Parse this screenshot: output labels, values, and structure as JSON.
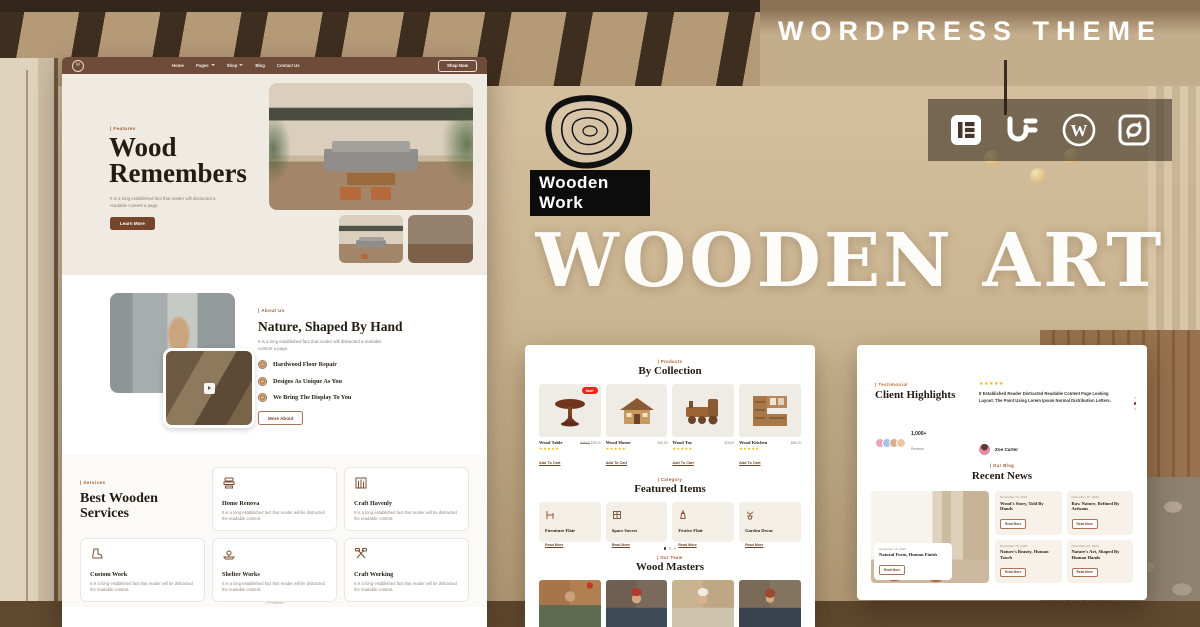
{
  "colors": {
    "accent": "#77452c",
    "header": "#6f4b39",
    "label": "#a05c2c",
    "stars": "#f0b400",
    "sale": "#e2261c"
  },
  "overlay": {
    "wordpress_theme_label": "WORDPRESS THEME",
    "big_title": "WOODEN ART",
    "logo_text": "Wooden Work",
    "icon_names": [
      "elementor-icon",
      "unlimited-elements-icon",
      "wordpress-icon",
      "sync-icon"
    ]
  },
  "site": {
    "nav": {
      "items": [
        "Home",
        "Pages",
        "Shop",
        "Blog",
        "Contact Us"
      ],
      "cta": "Shop Now"
    },
    "hero": {
      "label": "| Features",
      "title": "Wood Remembers",
      "body": "It is a long established fact that reader will distracted a readable content a page.",
      "cta": "Learn More"
    },
    "about": {
      "label": "| About Us",
      "title": "Nature, Shaped By Hand",
      "body": "It is a long established fact that reader will distracted a readable content a page.",
      "features": [
        "Hardwood Floor Repair",
        "Designs As Unique As You",
        "We Bring The Display To You"
      ],
      "cta": "More About"
    },
    "services": {
      "label": "| Services",
      "title": "Best Wooden Services",
      "card_body": "It is a long established fact that reader will be distracted the readable content.",
      "cards": [
        "Home Renova",
        "Craft Havenly",
        "Custom Work",
        "Shelter Works",
        "Craft Working"
      ]
    },
    "next_section_label": "| Products"
  },
  "shop": {
    "products": {
      "label": "| Products",
      "title": "By Collection",
      "cta": "Add To Cart",
      "items": [
        {
          "name": "Wood Table",
          "rating": "★★★★★",
          "price_old": "$49.00",
          "price": "$39.00",
          "sale": "Sale!"
        },
        {
          "name": "Wood House",
          "rating": "★★★★★",
          "price": "$45.00"
        },
        {
          "name": "Wood Toy",
          "rating": "★★★★★",
          "price": "$25.00"
        },
        {
          "name": "Wood Kitchen",
          "rating": "★★★★★",
          "price": "$55.00"
        }
      ]
    },
    "categories": {
      "label": "| Category",
      "title": "Featured Items",
      "link": "Read More",
      "items": [
        "Furniture Flair",
        "Space Savers",
        "Festive Flair",
        "Garden Decor"
      ]
    },
    "team": {
      "label": "| Our Team",
      "title": "Wood Masters"
    }
  },
  "panel3": {
    "testimonial": {
      "label": "| Testimonial",
      "title": "Client Highlights",
      "count": "1,000+",
      "count_sub": "Reviews",
      "stars": "★★★★★",
      "quote": "It Established Reader Distracted Readable Content Page Looking Layout. The Point Using Lorem Ipsum Normal Distribution Letters.",
      "author": "Zoe Carter"
    },
    "blog": {
      "label": "| Our Blog",
      "title": "Recent News",
      "date": "November 15, 2023",
      "read_more": "Read More",
      "posts": [
        "Natural Form, Human Finish",
        "Wood's Story, Told By Hands",
        "Raw Nature, Refined By Artisans",
        "Nature's Beauty, Human Touch",
        "Nature's Art, Shaped By Human Hands"
      ]
    }
  }
}
